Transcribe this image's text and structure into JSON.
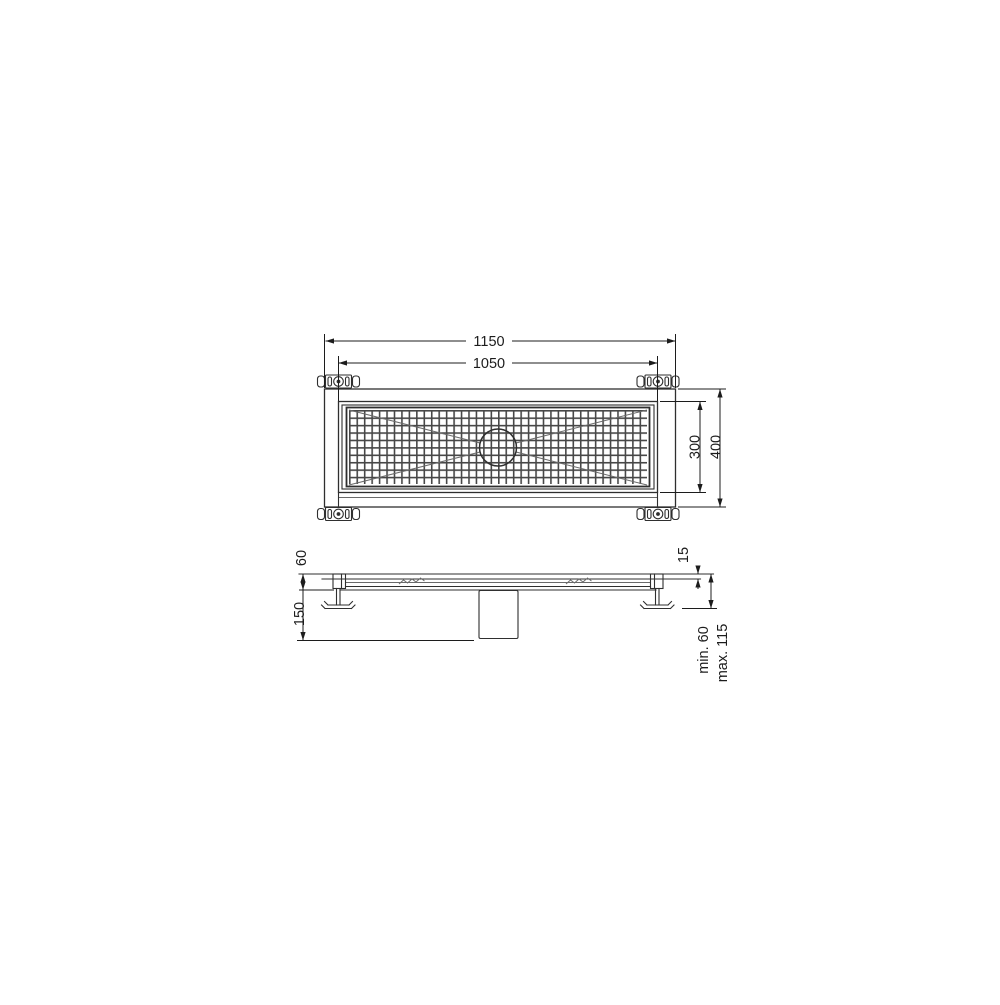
{
  "drawing": {
    "type": "technical-drawing-shower-channel-drain",
    "views": {
      "top": "top-view-plan",
      "side": "side-view-section"
    }
  },
  "labels": {
    "top_view": {
      "overall_length": "1150",
      "grate_length": "1050",
      "grate_width": "300",
      "overall_width": "400"
    },
    "side_view": {
      "body_height": "60",
      "outlet_depth": "150",
      "edge_height": "15",
      "install_min": "min. 60",
      "install_max": "max. 115"
    }
  },
  "colors": {
    "line": "#2f2f2f",
    "line_light": "#6a6a6a",
    "dim": "#1c1c1c",
    "mesh": "#474747",
    "bg": "#ffffff"
  }
}
